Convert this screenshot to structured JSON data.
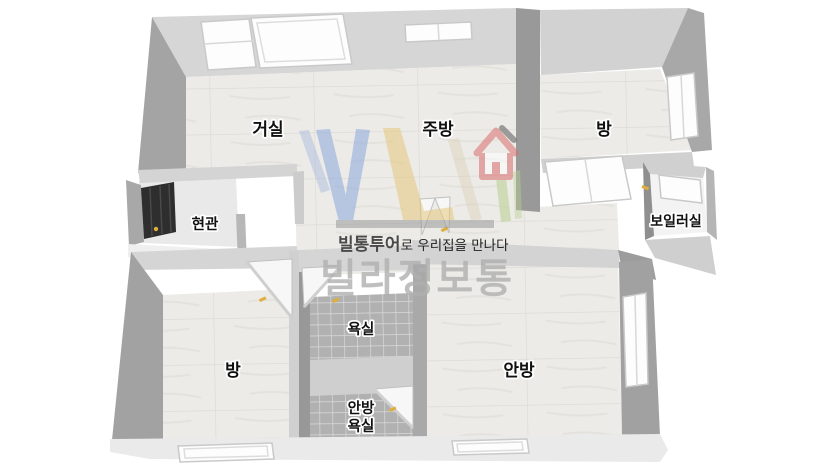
{
  "meta": {
    "kind": "3d-isometric-floor-plan",
    "background": "#ffffff"
  },
  "rooms": [
    {
      "id": "living-room",
      "label": "거실"
    },
    {
      "id": "kitchen",
      "label": "주방"
    },
    {
      "id": "bedroom-top-right",
      "label": "방"
    },
    {
      "id": "boiler-room",
      "label": "보일러실"
    },
    {
      "id": "entrance",
      "label": "현관"
    },
    {
      "id": "bathroom",
      "label": "욕실"
    },
    {
      "id": "bedroom-bottom-left",
      "label": "방"
    },
    {
      "id": "master-bedroom",
      "label": "안방"
    },
    {
      "id": "master-bathroom",
      "label": "안방 욕실",
      "line1": "안방",
      "line2": "욕실"
    }
  ],
  "watermark": {
    "tagline_brand": "빌통투어",
    "tagline_suffix": "로 우리집을 만나다",
    "brand_name": "빌라정보통",
    "logo_letters": "VL",
    "colors": {
      "logo_blue": "#8aa7dc",
      "logo_yellow": "#e6c87e",
      "logo_green": "#b9cf90",
      "logo_tan": "#d8cbb0",
      "house_red": "#d96d6d",
      "underline_bar": "#9a9a9a",
      "tagline_dark": "#4a4a4a",
      "tagline_text": "#222222",
      "brand_gray": "#b0b0b0"
    }
  },
  "palette": {
    "wall_light": "#d6d6d6",
    "wall_mid": "#b3b3b3",
    "wall_dark": "#9a9a9a",
    "floor_marble": "#ecebe7",
    "bath_tile": "#b1b1b1",
    "entrance_door": "#2e2e2e",
    "door_handle_yellow": "#dfae3c",
    "label_text": "#111111"
  }
}
